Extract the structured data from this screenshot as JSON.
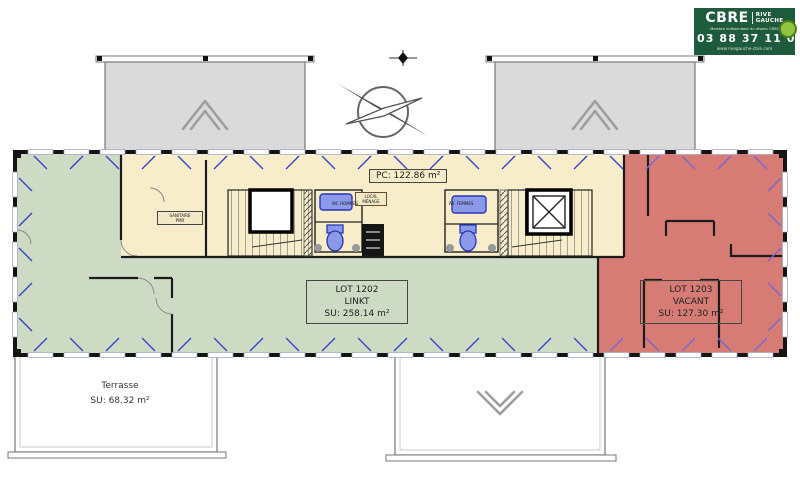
{
  "branding": {
    "logo": "CBRE",
    "brand_line1": "RIVE",
    "brand_line2": "GAUCHE",
    "tagline": "Membre indépendant du réseau CBRE",
    "phone": "03 88 37 11 00",
    "website": "www.rivegauche-cbre.com"
  },
  "plan": {
    "pc_area": "PC: 122.86 m²",
    "lot_1202": {
      "id": "LOT 1202",
      "tenant": "LINKT",
      "area": "SU: 258.14 m²"
    },
    "lot_1203": {
      "id": "LOT 1203",
      "status": "VACANT",
      "area": "SU: 127.30 m²"
    },
    "terrace": {
      "name": "Terrasse",
      "area": "SU: 68.32 m²"
    },
    "rooms": {
      "sanitaire_line1": "SANITAIRE",
      "sanitaire_line2": "PMR",
      "menage_line1": "LOCAL",
      "menage_line2": "MÉNAGE",
      "wc_hommes": "WC HOMMES",
      "wc_femmes": "WC FEMMES"
    },
    "colors": {
      "zone_linkt": "#cddbc4",
      "zone_vacant": "#d67c75",
      "zone_common": "#f7edca",
      "terrace": "#dadada",
      "window_mark_blue": "#3a46c8",
      "window_mark_violet": "#7668d0",
      "wall": "#1b1b1b",
      "brand_green": "#1e5a3c",
      "brand_lime": "#8fc43f"
    }
  }
}
